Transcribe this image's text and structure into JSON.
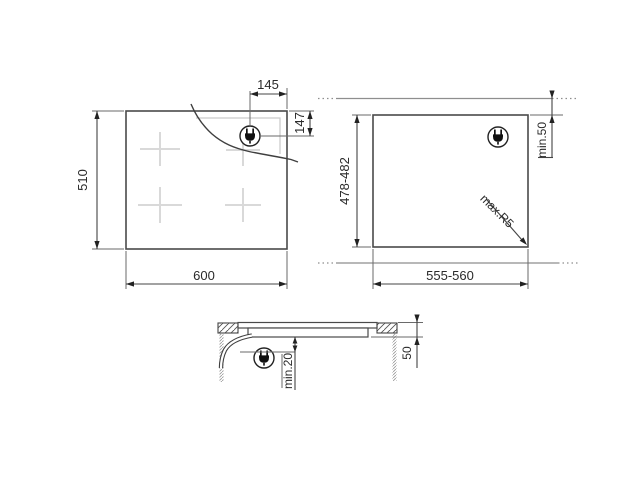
{
  "drawing": {
    "title": "hob-installation-dimensions",
    "top_view": {
      "width": "600",
      "height": "510",
      "plug_offset_from_right": "145",
      "plug_offset_from_top": "147",
      "icons": {
        "plug": "power-plug-icon"
      },
      "burner_marks": 4
    },
    "cutout_view": {
      "width": "555-560",
      "height": "478-482",
      "rear_clearance": "min.50",
      "corner_radius": "max.R5",
      "icons": {
        "plug": "power-plug-icon"
      }
    },
    "section_view": {
      "clearance_below": "min.20",
      "recess_depth": "50",
      "icons": {
        "plug": "power-plug-icon"
      }
    },
    "colors": {
      "main_line": "#4a4a4a",
      "dimension_line": "#444444",
      "extension_line": "#6a6a6a",
      "wall_line": "#8e8e8e",
      "burner_cross": "#d9d9d9",
      "text": "#2a2a2a"
    }
  }
}
